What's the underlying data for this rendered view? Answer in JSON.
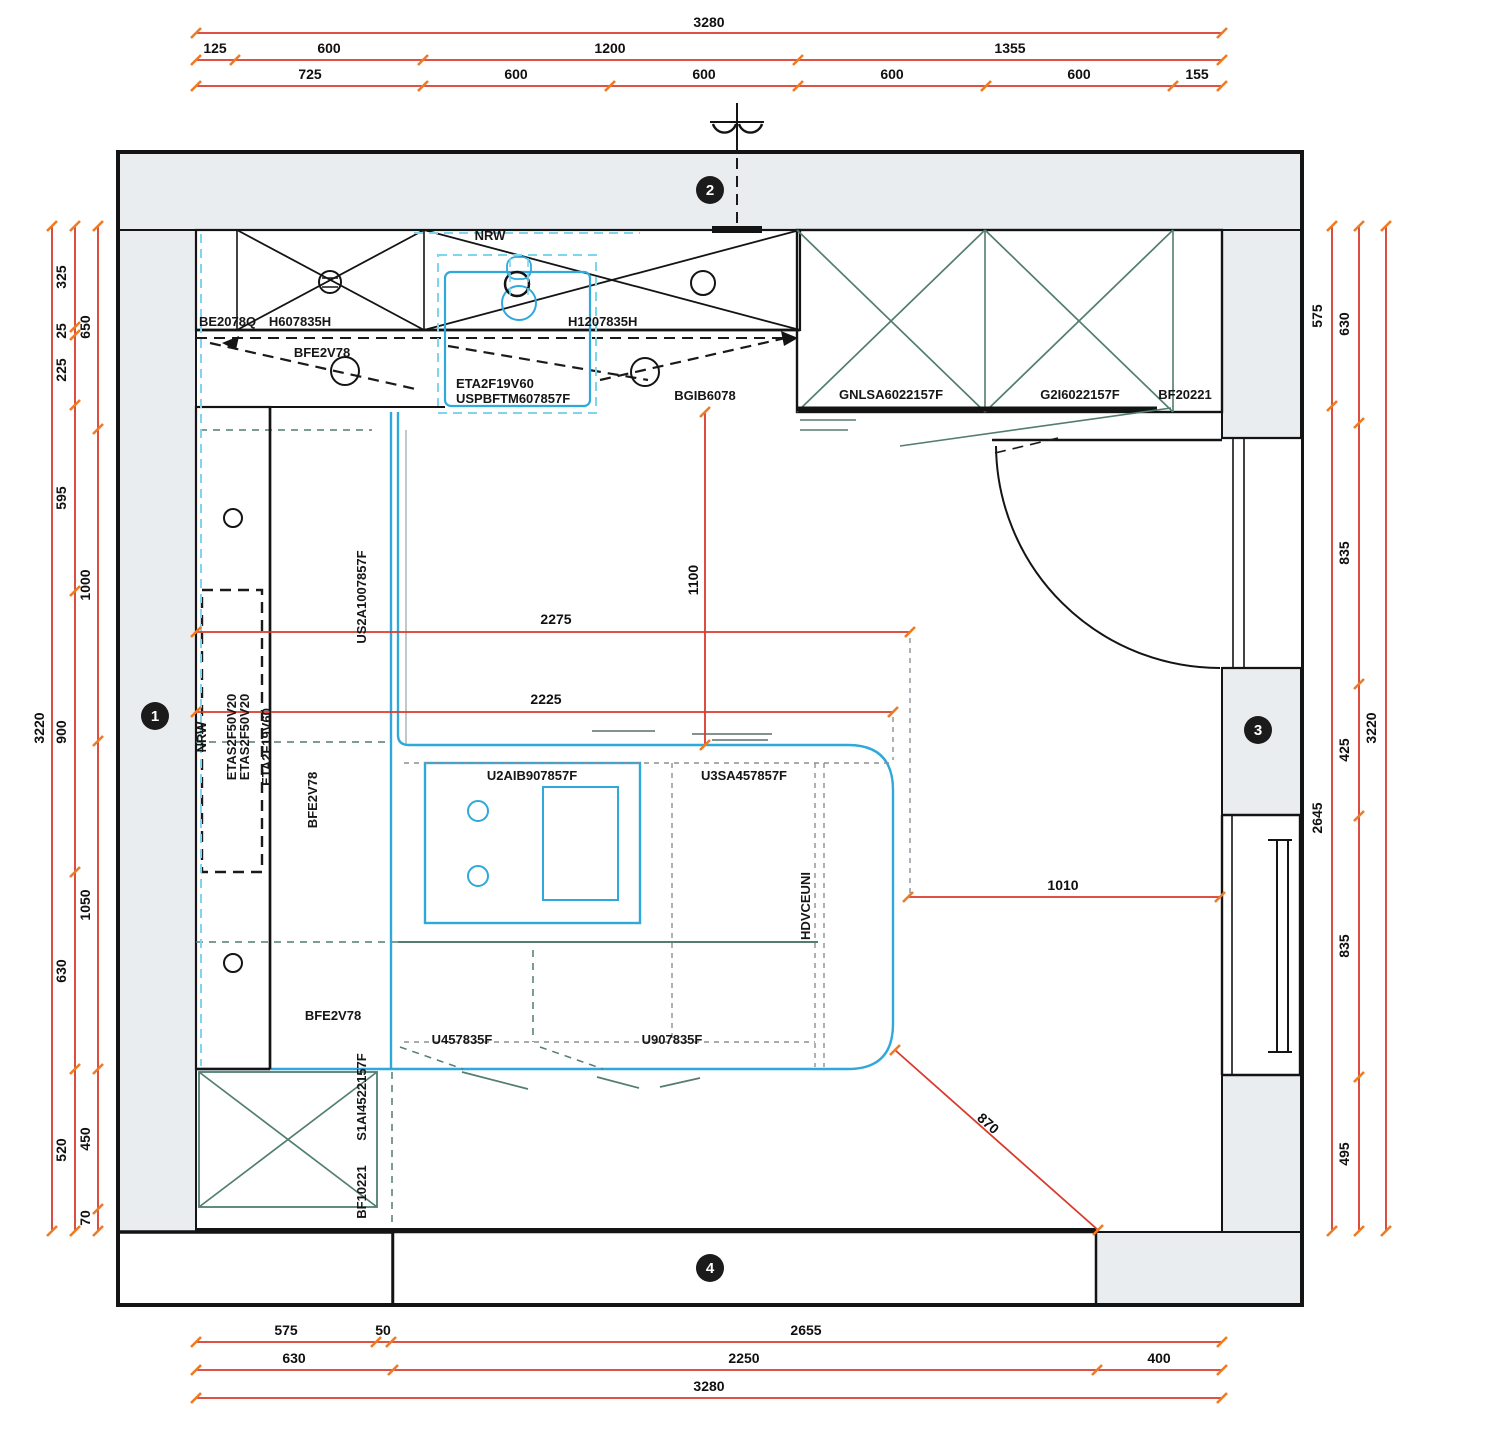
{
  "top_dims": {
    "total": "3280",
    "row2": [
      "125",
      "600",
      "1200",
      "1355"
    ],
    "row3": [
      "725",
      "600",
      "600",
      "600",
      "600",
      "155"
    ]
  },
  "bottom_dims": {
    "row1": [
      "575",
      "50",
      "2655"
    ],
    "row2": [
      "630",
      "2250",
      "400"
    ],
    "total": "3280"
  },
  "left_dims": {
    "total": "3220",
    "col2": [
      "325",
      "25",
      "225",
      "595",
      "900",
      "630",
      "520"
    ],
    "col3": [
      "650",
      "1000",
      "1050",
      "450",
      "70"
    ]
  },
  "right_dims": {
    "col1": [
      "575",
      "2645"
    ],
    "col2": [
      "630",
      "835",
      "425",
      "835",
      "495"
    ],
    "total": "3220"
  },
  "interior_dims": {
    "hood_to_island": "1100",
    "run_upper": "2275",
    "run_lower": "2225",
    "island_to_wall": "1010",
    "diagonal": "870"
  },
  "wall_labels": {
    "nrw_top": "NRW",
    "nrw_left": "NRW"
  },
  "cabinets": {
    "top_row": [
      "BE2078Q",
      "H607835H",
      "H1207835H"
    ],
    "bfe_top": "BFE2V78",
    "hood_line1": "ETA2F19V60",
    "hood_line2": "USPBFTM607857F",
    "bgib": "BGIB6078",
    "tall_right": [
      "GNLSA6022157F",
      "G2I6022157F",
      "BF20221"
    ],
    "left_col": {
      "etas1": "ETAS2F50V20",
      "etas2": "ETAS2F50V20",
      "eta": "ETA2F19V60",
      "us2a": "US2A1007857F",
      "bfe_mid": "BFE2V78"
    },
    "island": {
      "u2aib": "U2AIB907857F",
      "u3sa": "U3SA457857F",
      "hdv": "HDVCEUNI"
    },
    "bottom_row": {
      "bfe": "BFE2V78",
      "u45": "U457835F",
      "u90": "U907835F",
      "s1ai": "S1AI4522157F",
      "bf": "BF10221"
    }
  },
  "badges": {
    "b1": "1",
    "b2": "2",
    "b3": "3",
    "b4": "4"
  }
}
